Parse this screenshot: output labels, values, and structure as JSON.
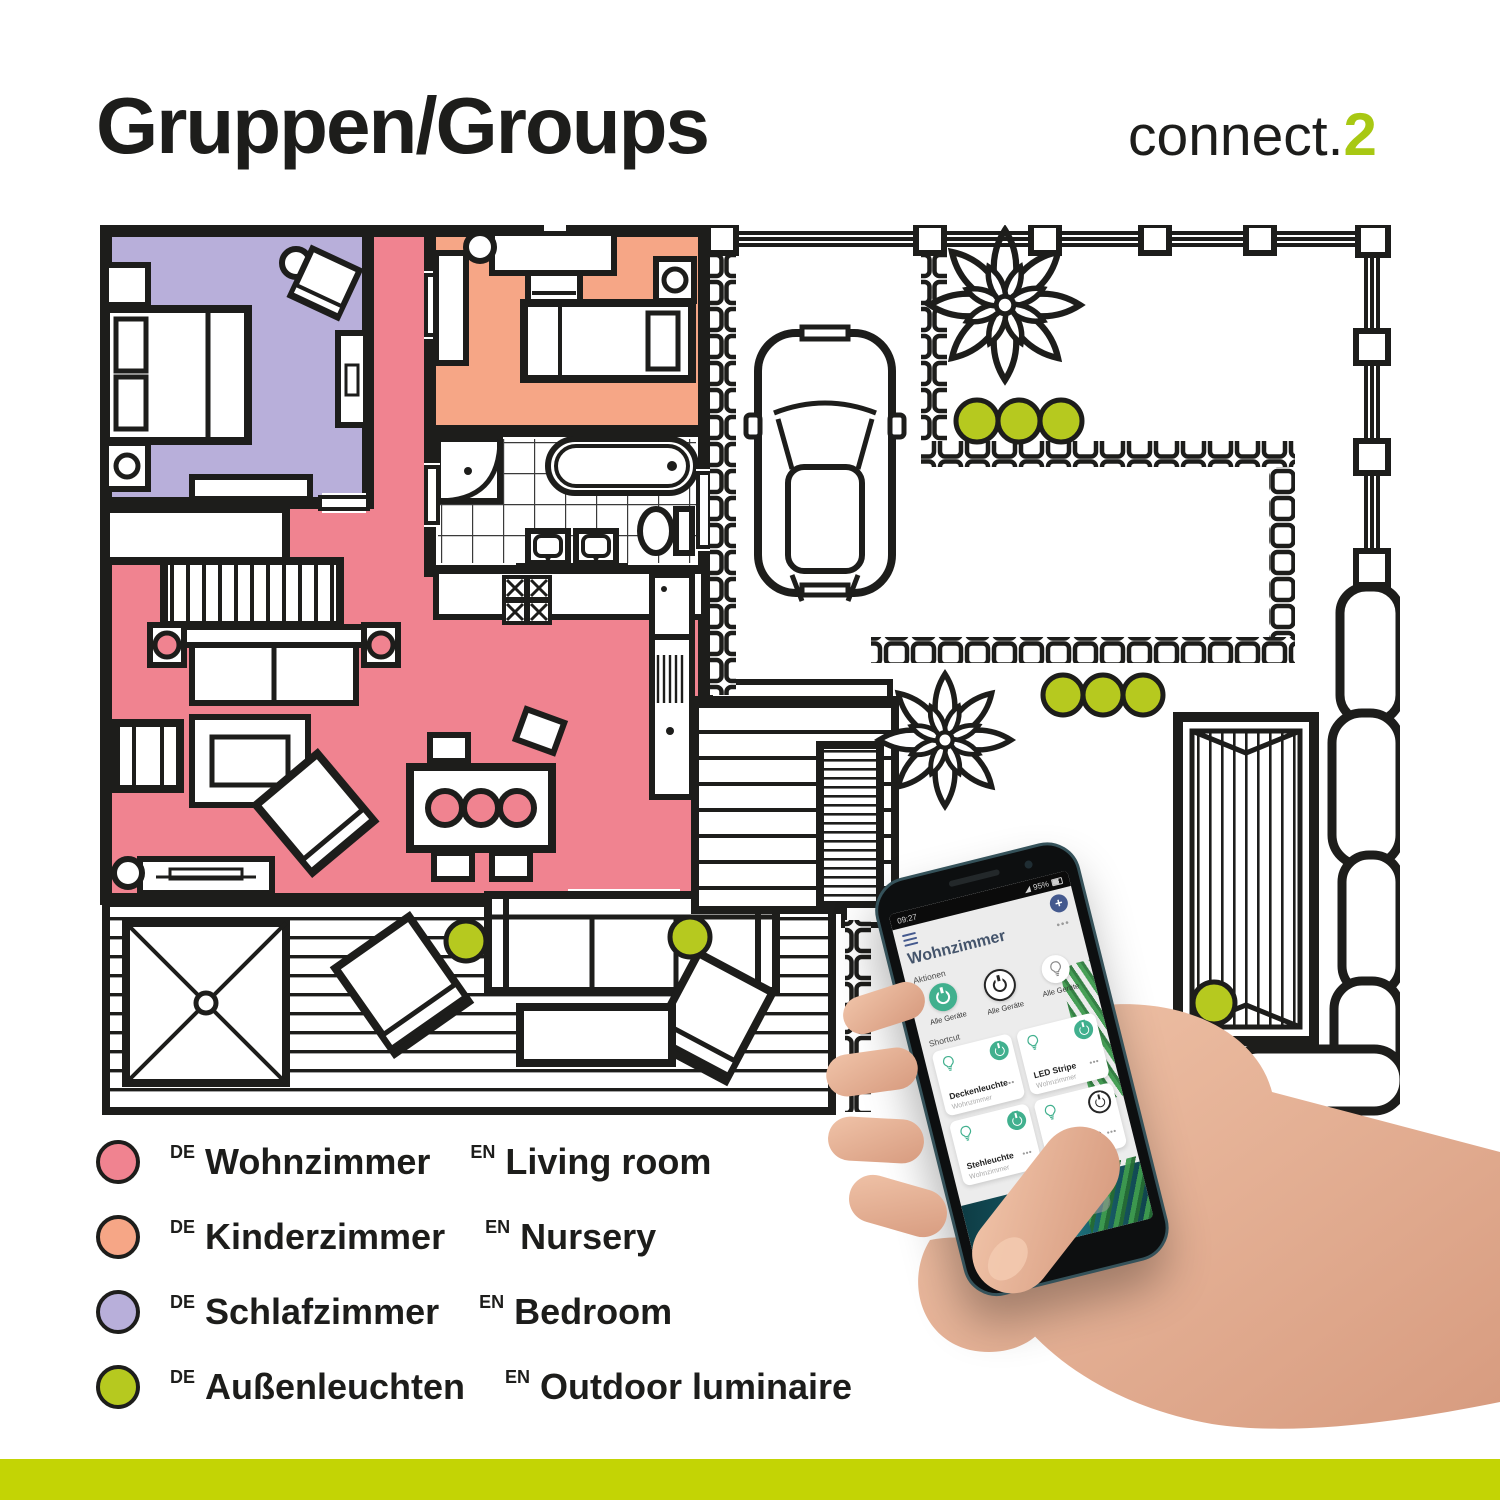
{
  "header": {
    "title": "Gruppen/Groups"
  },
  "logo": {
    "text": "connect.",
    "accent": "2"
  },
  "labels": {
    "de": "DE",
    "en": "EN"
  },
  "legend": {
    "items": [
      {
        "de": "Wohnzimmer",
        "en": "Living room",
        "key": "living"
      },
      {
        "de": "Kinderzimmer",
        "en": "Nursery",
        "key": "nursery"
      },
      {
        "de": "Schlafzimmer",
        "en": "Bedroom",
        "key": "bedroom"
      },
      {
        "de": "Außenleuchten",
        "en": "Outdoor luminaire",
        "key": "outdoor"
      }
    ]
  },
  "colors": {
    "living": "#f08390",
    "nursery": "#f6a686",
    "bedroom": "#b8afda",
    "outdoor": "#b6c91f",
    "accent_green": "#a8c813",
    "bottom_bar": "#c3d405",
    "wall": "#1d1d1b",
    "app_green": "#41b08e",
    "app_blue": "#44598e",
    "app_title": "#44546b"
  },
  "floor_plan": {
    "outdoor_light_count": 9
  },
  "icons": {
    "home": "⌂"
  },
  "phone": {
    "status": {
      "time": "09:27",
      "battery": "95%"
    },
    "app": {
      "title": "Wohnzimmer",
      "add": "+",
      "more": "•••",
      "actions_label": "Aktionen",
      "actions": [
        {
          "label": "Alle Geräte"
        },
        {
          "label": "Alle Geräte"
        },
        {
          "label": "Alle Geräte"
        }
      ],
      "shortcut_label": "Shortcut",
      "tiles": [
        {
          "name": "Deckenleuchte",
          "room": "Wohnzimmer",
          "power": "on"
        },
        {
          "name": "LED Stripe",
          "room": "Wohnzimmer",
          "power": "on"
        },
        {
          "name": "Stehleuchte",
          "room": "Wohnzimmer",
          "power": "on"
        },
        {
          "name": "Tischleuchte",
          "room": "Wohnzimmer",
          "power": "off"
        }
      ]
    }
  }
}
